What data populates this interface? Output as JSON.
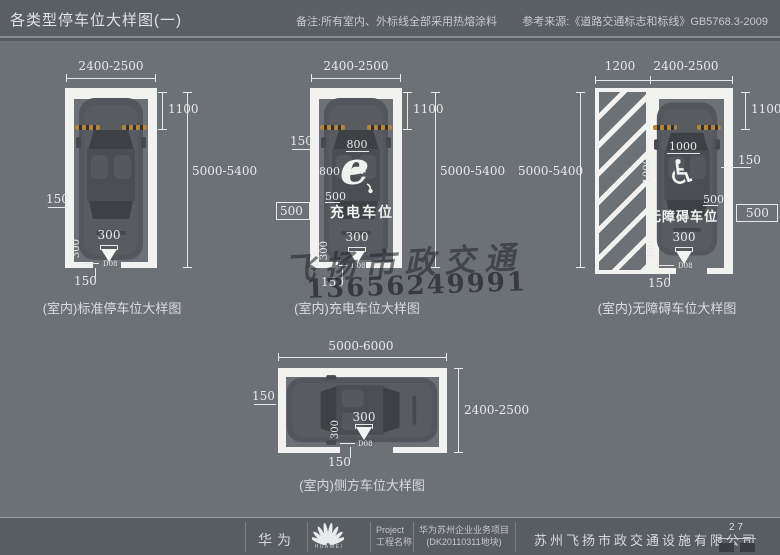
{
  "header": {
    "title": "各类型停车位大样图(一)",
    "note": "备注:所有室内、外标线全部采用热熔涂料",
    "reference": "参考来源:《道路交通标志和标线》GB5768.3-2009"
  },
  "d1": {
    "caption": "(室内)标准停车位大样图",
    "width": "2400-2500",
    "front": "1100",
    "length": "5000-5400",
    "line": "150",
    "arrow_w": "300",
    "arrow_h": "300",
    "bottom": "150",
    "detail": "D08"
  },
  "d2": {
    "caption": "(室内)充电车位大样图",
    "label": "充电车位",
    "symbol": "e",
    "width": "2400-2500",
    "front": "1100",
    "length": "5000-5400",
    "line": "150",
    "sym_w": "800",
    "sym_h": "800",
    "gap": "500",
    "side": "500",
    "arrow_w": "300",
    "arrow_h": "300",
    "bottom": "150",
    "detail": "D08"
  },
  "d3": {
    "caption": "(室内)无障碍车位大样图",
    "label": "无障碍车位",
    "wheelchair": "♿",
    "hatch_w": "1200",
    "width": "2400-2500",
    "front": "1100",
    "length": "5000-5400",
    "line": "150",
    "sym_w": "1000",
    "sym_h": "1000",
    "gap": "500",
    "side": "500",
    "arrow_w": "300",
    "arrow_h": "300",
    "bottom": "150",
    "detail": "D08"
  },
  "d4": {
    "caption": "(室内)侧方车位大样图",
    "width": "5000-6000",
    "depth": "2400-2500",
    "line": "150",
    "arrow_w": "300",
    "arrow_h": "300",
    "bottom": "150",
    "detail": "D08"
  },
  "watermark": {
    "name": "飞扬市政交通",
    "phone": "13656249991"
  },
  "footer": {
    "brand": "华为",
    "logo_word": "HUAWEI",
    "project_label_en": "Project",
    "project_label_zh": "工程名称",
    "project_name": "华为苏州企业业务项目",
    "project_code": "(DK20110311地块)",
    "company": "苏州飞扬市政交通设施有限公司",
    "page": "2 7"
  }
}
